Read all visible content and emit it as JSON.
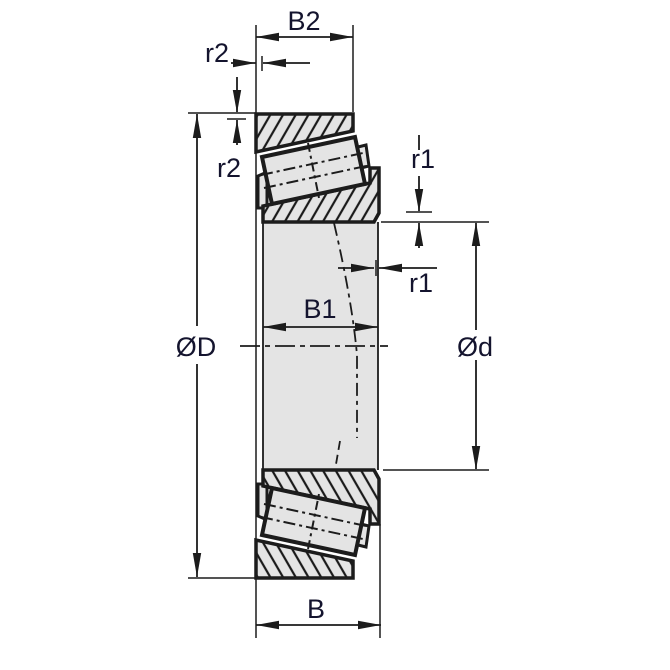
{
  "drawing": {
    "subject": "Tapered roller bearing cross-section dimensional drawing",
    "labels": {
      "b2": "B2",
      "r2_horizontal": "r2",
      "r2_vertical": "r2",
      "r1_vertical": "r1",
      "r1_horizontal": "r1",
      "b1": "B1",
      "outer_diameter": "ØD",
      "bore_diameter": "Ød",
      "overall_width": "B"
    },
    "colors": {
      "line": "#1c1c1c",
      "part_fill": "#e4e4e4",
      "label_text": "#14142e",
      "background": "#ffffff"
    }
  }
}
